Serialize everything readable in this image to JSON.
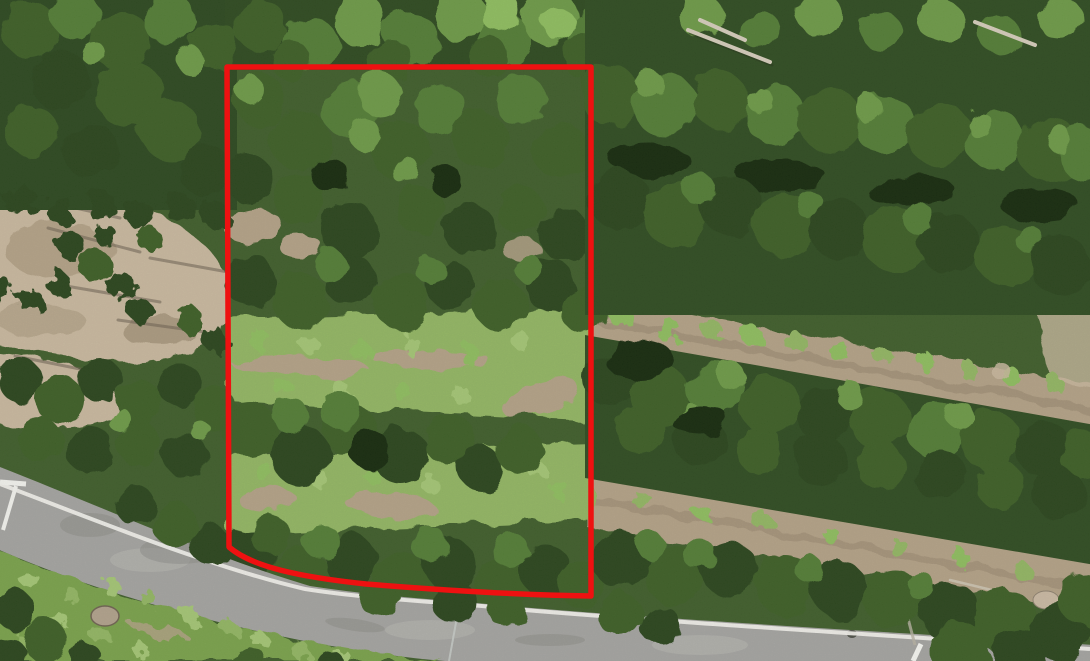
{
  "window": {
    "title": "Aerial drone photo of forested parcel with red boundary outline"
  },
  "photo": {
    "description": "Top-down aerial drone photograph of a rural forested parcel. Dense conifer and deciduous canopy covers most of the frame; diagonal rows of trees separated by bare dirt strips fill the right half; a light dirt clearing with scattered young conifers and long thin tree shadows sits on the left middle; bright green brushy strips cross the center of the outlined parcel; a curved paved road with a white fog line runs from the left edge to the bottom right, with a grassy verge and dark trees in the bottom-left corner.",
    "features": {
      "road": "paved asphalt road with white edge (fog) line, entering at left edge and exiting bottom right under tree cover",
      "road_markers": "small white roadside marker at far left and a short white post near the bottom right",
      "clearing": "bare tan dirt clearing with small conifers and long diagonal shadows, left middle",
      "tree_rows": "planted rows of trees with tan dirt access strips between them, right half",
      "grass_strips": "bright green scrub/grass strips with dirt tracks inside the red outline",
      "fallen_logs": "pale grey fallen logs upper right and a small log/slash pile lower right",
      "rocks": "small boulder on the grassy verge lower left and another beside the dirt strip lower right"
    }
  },
  "annotation": {
    "name": "parcel-boundary",
    "shape": "rectangle with vertical sides, straight top, and a sagging curved bottom edge following the road",
    "color": "#ee1111",
    "stroke_width": 5.5,
    "svg_path": "M 227,67 L 591,67 L 591,596 C 515,595 440,590 366,584 C 300,577 252,567 229,547 Z",
    "bounds": {
      "left": 227,
      "top": 67,
      "right": 591,
      "bottom": 597
    }
  },
  "palette": {
    "canopy_dark": "#2a451d",
    "canopy_mid": "#3d5f27",
    "canopy_light": "#537d36",
    "canopy_bright": "#6d9a46",
    "scrub_lime": "#8fbe5f",
    "dirt_light": "#c9b99f",
    "dirt_mid": "#b4a287",
    "grass": "#93b763",
    "road_asphalt": "#a5a4a1",
    "road_fog_line": "#f2f1ec",
    "boundary_red": "#ee1111"
  }
}
